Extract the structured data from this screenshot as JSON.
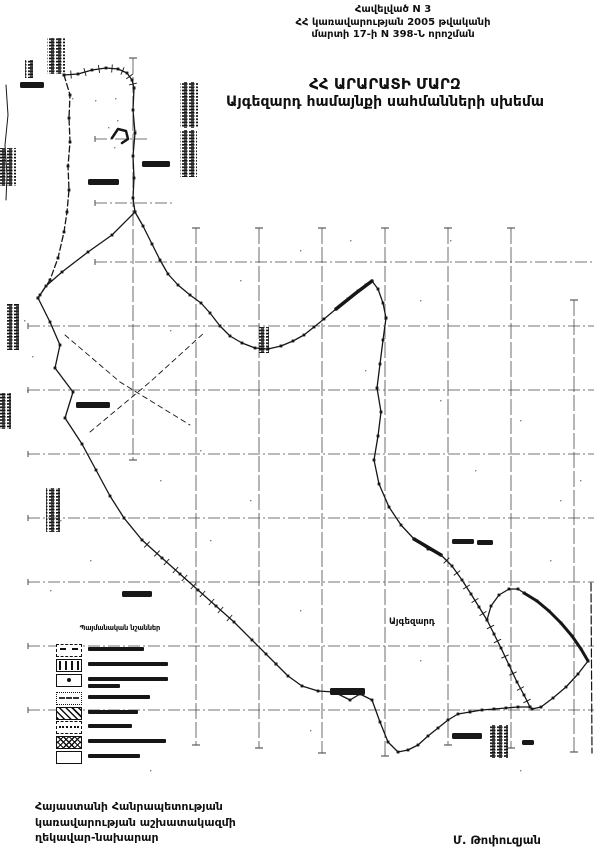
{
  "document": {
    "appendix": [
      "Հավելված N 3",
      "ՀՀ կառավարության 2005 թվականի",
      "մարտի 17-ի N 398-Ն որոշման"
    ],
    "title1": "ՀՀ ԱՐԱՐԱՏԻ ՄԱՐԶ",
    "title2": "Այգեզարդ համայնքի սահմանների սխեմա",
    "footer": {
      "line1": "Հայաստանի Հանրապետության",
      "line2": "կառավարության աշխատակազմի",
      "line3": "ղեկավար-նախարար",
      "signature": "Մ. Թոփուզյան"
    }
  },
  "legend": {
    "title": "Պայմանական նշաններ",
    "row_y": [
      24,
      39,
      54,
      72,
      87,
      101,
      116,
      131
    ],
    "items": [
      {
        "icon": "dashdot",
        "bars": [
          56
        ]
      },
      {
        "icon": "ticks",
        "bars": [
          80
        ]
      },
      {
        "icon": "dot",
        "bars": [
          80,
          32
        ]
      },
      {
        "icon": "dashes",
        "bars": [
          62
        ]
      },
      {
        "icon": "hatch",
        "bars": [
          50
        ]
      },
      {
        "icon": "dotted",
        "bars": [
          44
        ]
      },
      {
        "icon": "cross",
        "bars": [
          78
        ]
      },
      {
        "icon": "empty",
        "bars": [
          52
        ]
      }
    ]
  },
  "map": {
    "ink": "#161616",
    "grid_color": "#4a4a4a",
    "grid": {
      "verticals": [
        {
          "x": 133,
          "y1": 58,
          "y2": 460
        },
        {
          "x": 196,
          "y1": 228,
          "y2": 745
        },
        {
          "x": 259,
          "y1": 228,
          "y2": 748
        },
        {
          "x": 322,
          "y1": 228,
          "y2": 753
        },
        {
          "x": 385,
          "y1": 228,
          "y2": 756
        },
        {
          "x": 448,
          "y1": 228,
          "y2": 745
        },
        {
          "x": 511,
          "y1": 228,
          "y2": 748
        },
        {
          "x": 574,
          "y1": 300,
          "y2": 752
        }
      ],
      "horizontals": [
        {
          "y": 139,
          "x1": 95,
          "x2": 148
        },
        {
          "y": 203,
          "x1": 95,
          "x2": 172
        },
        {
          "y": 262,
          "x1": 95,
          "x2": 594
        },
        {
          "y": 326,
          "x1": 28,
          "x2": 594
        },
        {
          "y": 390,
          "x1": 28,
          "x2": 594
        },
        {
          "y": 454,
          "x1": 28,
          "x2": 594
        },
        {
          "y": 518,
          "x1": 28,
          "x2": 594
        },
        {
          "y": 582,
          "x1": 28,
          "x2": 594
        },
        {
          "y": 646,
          "x1": 28,
          "x2": 594
        },
        {
          "y": 710,
          "x1": 28,
          "x2": 594
        }
      ]
    },
    "boundaries": [
      {
        "name": "northwest-top",
        "dots": true,
        "ticks": true,
        "points": [
          [
            64,
            75
          ],
          [
            78,
            74
          ],
          [
            92,
            70
          ],
          [
            106,
            68
          ],
          [
            118,
            69
          ],
          [
            127,
            73
          ],
          [
            132,
            80
          ],
          [
            134,
            88
          ]
        ]
      },
      {
        "name": "west-line",
        "dots": true,
        "dash": "6 3",
        "points": [
          [
            64,
            75
          ],
          [
            70,
            95
          ],
          [
            69,
            118
          ],
          [
            70,
            142
          ],
          [
            68,
            166
          ],
          [
            69,
            190
          ],
          [
            67,
            212
          ],
          [
            64,
            232
          ],
          [
            58,
            258
          ],
          [
            50,
            280
          ],
          [
            40,
            295
          ],
          [
            38,
            298
          ]
        ]
      },
      {
        "name": "north-vertical",
        "dots": true,
        "points": [
          [
            134,
            88
          ],
          [
            133,
            110
          ],
          [
            135,
            133
          ],
          [
            133,
            156
          ],
          [
            134,
            178
          ],
          [
            133,
            198
          ],
          [
            135,
            212
          ]
        ]
      },
      {
        "name": "northwest-diagonal",
        "dots": true,
        "points": [
          [
            135,
            212
          ],
          [
            112,
            235
          ],
          [
            88,
            252
          ],
          [
            62,
            272
          ],
          [
            46,
            286
          ],
          [
            38,
            298
          ]
        ]
      },
      {
        "name": "southeast-diagonal",
        "dots": true,
        "points": [
          [
            38,
            298
          ],
          [
            50,
            322
          ],
          [
            60,
            345
          ],
          [
            55,
            368
          ],
          [
            73,
            392
          ],
          [
            65,
            418
          ],
          [
            82,
            444
          ],
          [
            96,
            470
          ],
          [
            110,
            496
          ],
          [
            124,
            518
          ],
          [
            142,
            540
          ],
          [
            162,
            558
          ],
          [
            180,
            574
          ],
          [
            198,
            590
          ],
          [
            216,
            606
          ],
          [
            234,
            622
          ],
          [
            252,
            640
          ],
          [
            266,
            654
          ],
          [
            276,
            664
          ]
        ]
      },
      {
        "name": "railway-hatches",
        "line": false,
        "ticks": true,
        "points": [
          [
            142,
            540
          ],
          [
            152,
            549
          ],
          [
            162,
            558
          ],
          [
            171,
            566
          ],
          [
            180,
            574
          ],
          [
            189,
            582
          ],
          [
            198,
            590
          ],
          [
            207,
            598
          ],
          [
            216,
            606
          ],
          [
            225,
            614
          ],
          [
            234,
            622
          ]
        ]
      },
      {
        "name": "south-boundary",
        "dots": true,
        "points": [
          [
            276,
            664
          ],
          [
            288,
            676
          ],
          [
            302,
            686
          ],
          [
            318,
            691
          ],
          [
            334,
            692
          ],
          [
            350,
            700
          ],
          [
            360,
            694
          ],
          [
            372,
            700
          ],
          [
            380,
            722
          ],
          [
            388,
            742
          ],
          [
            398,
            752
          ],
          [
            408,
            750
          ],
          [
            418,
            745
          ],
          [
            428,
            736
          ],
          [
            438,
            728
          ],
          [
            448,
            720
          ],
          [
            458,
            714
          ],
          [
            470,
            712
          ],
          [
            482,
            710
          ],
          [
            494,
            709
          ],
          [
            506,
            708
          ],
          [
            518,
            707
          ],
          [
            530,
            707
          ]
        ]
      },
      {
        "name": "east-vertical",
        "dots": true,
        "points": [
          [
            386,
            318
          ],
          [
            383,
            340
          ],
          [
            380,
            364
          ],
          [
            377,
            388
          ],
          [
            381,
            412
          ],
          [
            378,
            436
          ],
          [
            374,
            460
          ],
          [
            379,
            484
          ],
          [
            389,
            507
          ],
          [
            401,
            525
          ],
          [
            414,
            539
          ],
          [
            428,
            549
          ],
          [
            441,
            555
          ]
        ]
      },
      {
        "name": "east-vertical-thick",
        "w": 3.5,
        "points": [
          [
            414,
            539
          ],
          [
            441,
            555
          ]
        ]
      },
      {
        "name": "central-u-curve",
        "dots": true,
        "points": [
          [
            135,
            212
          ],
          [
            143,
            226
          ],
          [
            152,
            244
          ],
          [
            160,
            260
          ],
          [
            168,
            274
          ],
          [
            178,
            285
          ],
          [
            190,
            295
          ],
          [
            201,
            303
          ],
          [
            210,
            313
          ],
          [
            220,
            326
          ],
          [
            230,
            336
          ],
          [
            242,
            343
          ],
          [
            255,
            348
          ],
          [
            268,
            349
          ],
          [
            281,
            346
          ],
          [
            293,
            341
          ],
          [
            304,
            335
          ],
          [
            314,
            327
          ],
          [
            324,
            319
          ],
          [
            336,
            309
          ],
          [
            348,
            299
          ],
          [
            358,
            291
          ],
          [
            366,
            285
          ],
          [
            372,
            281
          ],
          [
            378,
            289
          ],
          [
            383,
            303
          ],
          [
            386,
            318
          ]
        ]
      },
      {
        "name": "u-curve-thick",
        "w": 3.5,
        "points": [
          [
            336,
            309
          ],
          [
            356,
            293
          ],
          [
            372,
            281
          ]
        ]
      },
      {
        "name": "steep-diagonal",
        "dots": true,
        "ticks": true,
        "points": [
          [
            441,
            555
          ],
          [
            452,
            566
          ],
          [
            462,
            580
          ],
          [
            471,
            594
          ],
          [
            479,
            607
          ],
          [
            487,
            620
          ],
          [
            494,
            634
          ],
          [
            501,
            648
          ],
          [
            509,
            665
          ],
          [
            517,
            682
          ],
          [
            524,
            695
          ],
          [
            530,
            707
          ]
        ]
      },
      {
        "name": "loop-rise",
        "dots": true,
        "points": [
          [
            487,
            620
          ],
          [
            491,
            606
          ],
          [
            499,
            595
          ],
          [
            509,
            589
          ],
          [
            518,
            589
          ],
          [
            524,
            593
          ]
        ]
      },
      {
        "name": "loop-thick",
        "dots": true,
        "w": 3,
        "points": [
          [
            524,
            593
          ],
          [
            537,
            601
          ],
          [
            549,
            611
          ],
          [
            561,
            623
          ],
          [
            572,
            636
          ],
          [
            581,
            649
          ],
          [
            588,
            661
          ]
        ]
      },
      {
        "name": "corner-return",
        "dots": true,
        "points": [
          [
            588,
            661
          ],
          [
            578,
            674
          ],
          [
            566,
            687
          ],
          [
            553,
            698
          ],
          [
            541,
            707
          ],
          [
            532,
            709
          ],
          [
            530,
            707
          ]
        ]
      },
      {
        "name": "east-border",
        "dash": "8 3",
        "w": 1.2,
        "points": [
          [
            591,
            583
          ],
          [
            592,
            753
          ]
        ]
      },
      {
        "name": "left-spur",
        "w": 1,
        "points": [
          [
            6,
            85
          ],
          [
            8,
            115
          ],
          [
            5,
            145
          ],
          [
            7,
            175
          ],
          [
            6,
            200
          ]
        ]
      },
      {
        "name": "hook-blob",
        "w": 2.5,
        "points": [
          [
            112,
            138
          ],
          [
            118,
            129
          ],
          [
            126,
            131
          ],
          [
            128,
            139
          ],
          [
            122,
            143
          ]
        ]
      },
      {
        "name": "inner-dashed-1",
        "dash": "5 4",
        "w": 0.9,
        "points": [
          [
            65,
            335
          ],
          [
            120,
            382
          ],
          [
            190,
            425
          ]
        ]
      },
      {
        "name": "inner-dashed-2",
        "dash": "5 4",
        "w": 0.9,
        "points": [
          [
            90,
            432
          ],
          [
            150,
            382
          ],
          [
            205,
            332
          ]
        ]
      }
    ],
    "stamps": [
      {
        "x": 47,
        "y": 38,
        "w": 18,
        "h": 36
      },
      {
        "x": 25,
        "y": 60,
        "w": 8,
        "h": 18
      },
      {
        "x": 0,
        "y": 148,
        "w": 16,
        "h": 38
      },
      {
        "x": 180,
        "y": 82,
        "w": 18,
        "h": 46
      },
      {
        "x": 180,
        "y": 130,
        "w": 17,
        "h": 47
      },
      {
        "x": 6,
        "y": 304,
        "w": 13,
        "h": 46
      },
      {
        "x": 0,
        "y": 393,
        "w": 11,
        "h": 36
      },
      {
        "x": 46,
        "y": 488,
        "w": 14,
        "h": 44
      },
      {
        "x": 490,
        "y": 725,
        "w": 18,
        "h": 33
      },
      {
        "x": 258,
        "y": 327,
        "w": 11,
        "h": 26
      }
    ],
    "labels": [
      {
        "x": 389,
        "y": 624,
        "text": "Այգեզարդ",
        "size": 8.5
      }
    ],
    "label_bars": [
      {
        "x": 20,
        "y": 82,
        "w": 24,
        "h": 6
      },
      {
        "x": 142,
        "y": 161,
        "w": 28,
        "h": 6
      },
      {
        "x": 88,
        "y": 179,
        "w": 31,
        "h": 6
      },
      {
        "x": 76,
        "y": 402,
        "w": 34,
        "h": 6
      },
      {
        "x": 122,
        "y": 591,
        "w": 30,
        "h": 6
      },
      {
        "x": 330,
        "y": 688,
        "w": 35,
        "h": 7
      },
      {
        "x": 452,
        "y": 539,
        "w": 22,
        "h": 5
      },
      {
        "x": 477,
        "y": 540,
        "w": 16,
        "h": 5
      },
      {
        "x": 452,
        "y": 733,
        "w": 30,
        "h": 6
      },
      {
        "x": 522,
        "y": 740,
        "w": 12,
        "h": 5
      }
    ],
    "speckles": [
      [
        95,
        100
      ],
      [
        108,
        127
      ],
      [
        115,
        98
      ],
      [
        117,
        120
      ],
      [
        114,
        147
      ],
      [
        135,
        130
      ],
      [
        72,
        98
      ],
      [
        24,
        320
      ],
      [
        32,
        356
      ],
      [
        27,
        390
      ],
      [
        300,
        250
      ],
      [
        420,
        300
      ],
      [
        520,
        420
      ],
      [
        560,
        500
      ],
      [
        200,
        450
      ],
      [
        250,
        500
      ],
      [
        90,
        560
      ],
      [
        300,
        610
      ],
      [
        550,
        560
      ],
      [
        420,
        660
      ],
      [
        310,
        730
      ],
      [
        150,
        770
      ],
      [
        520,
        770
      ],
      [
        50,
        590
      ],
      [
        580,
        480
      ],
      [
        450,
        240
      ],
      [
        350,
        240
      ],
      [
        240,
        280
      ],
      [
        170,
        330
      ],
      [
        60,
        520
      ],
      [
        365,
        370
      ],
      [
        440,
        400
      ],
      [
        475,
        470
      ],
      [
        160,
        480
      ],
      [
        210,
        540
      ]
    ]
  }
}
